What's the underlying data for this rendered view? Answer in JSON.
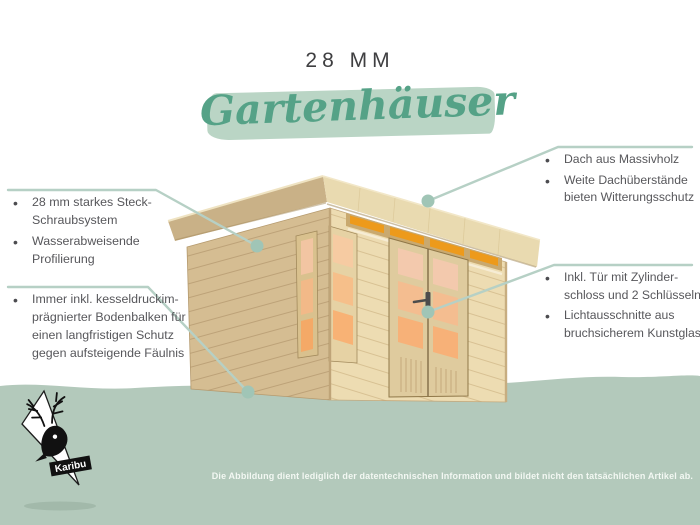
{
  "header": {
    "size_label": "28 MM",
    "title": "Gartenhäuser"
  },
  "notes": {
    "left_top": {
      "items": [
        "28 mm starkes Steck-Schraubsystem",
        "Wasserabweisende Profilierung"
      ]
    },
    "left_bottom": {
      "items": [
        "Immer inkl. kesseldruckim-prägnierter Bodenbalken für einen langfristigen Schutz gegen aufsteigende Fäulnis"
      ]
    },
    "right_top": {
      "items": [
        "Dach aus Massivholz",
        "Weite Dachüberstände bieten Witterungsschutz"
      ]
    },
    "right_bottom": {
      "items": [
        "Inkl. Tür mit Zylinder-schloss und 2 Schlüsseln",
        "Lichtausschnitte aus bruchsicherem Kunstglas"
      ]
    }
  },
  "footer": {
    "disclaimer": "Die Abbildung dient lediglich der datentechnischen Information und bildet nicht den tatsächlichen Artikel ab."
  },
  "logo": {
    "brand": "Karibu"
  },
  "colors": {
    "accent_green": "#55a287",
    "brush_green": "#bad5c5",
    "band_green": "#b3c9bb",
    "leader_line": "#b6d0c5",
    "leader_dot": "#a0c5b6",
    "text_gray": "#57575b",
    "window_orange": "#ed9a1b"
  }
}
